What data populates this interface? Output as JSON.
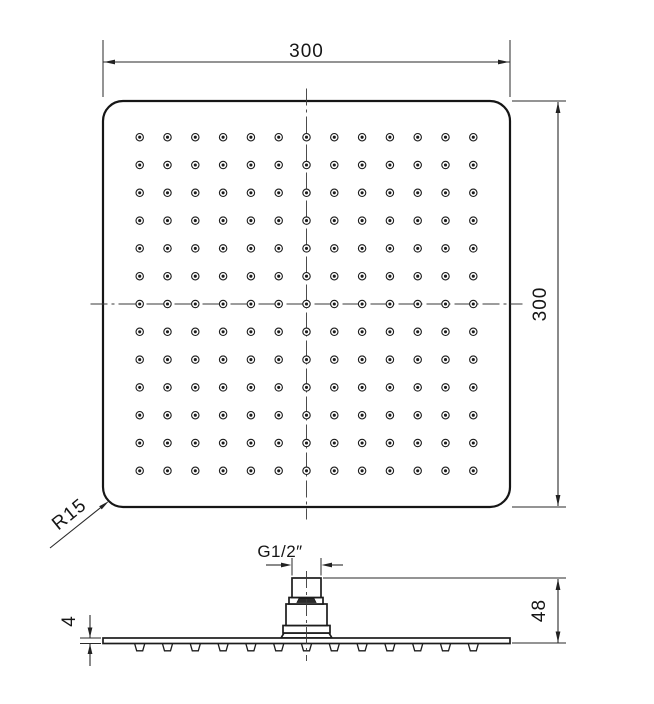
{
  "drawing": {
    "top_view": {
      "width_dim": "300",
      "side_dim": "300",
      "corner_radius_label": "R15"
    },
    "side_view": {
      "thread_label": "G1/2″",
      "overall_height_dim": "48",
      "plate_thickness_dim": "4"
    },
    "nozzle_grid": {
      "rows": 13,
      "cols": 13
    },
    "colors": {
      "line": "#1c1c1c",
      "background": "#ffffff"
    }
  }
}
